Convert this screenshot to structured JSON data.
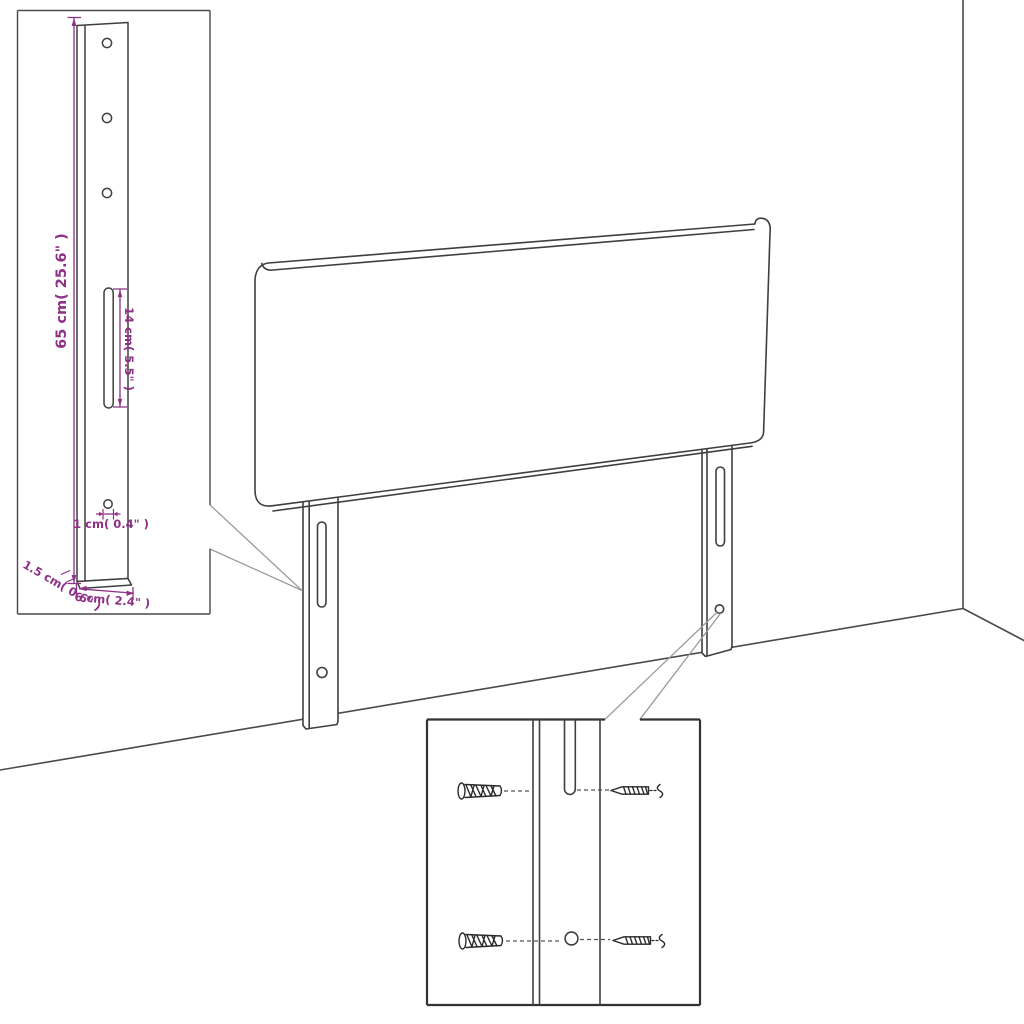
{
  "diagram": {
    "type": "product-assembly-dimension-diagram",
    "subject": "upholstered headboard with two adjustable mounting legs shown in a room corner",
    "colors": {
      "outline": "#3f3f3f",
      "callout": "#9b9b9b",
      "dimension": "#8e3087",
      "inset_border": "#333333",
      "background": "#ffffff"
    },
    "dimensions": {
      "leg_height": "65 cm( 25.6\" )",
      "slot_length": "14 cm( 5.5\" )",
      "hole_diameter": "1 cm( 0.4\" )",
      "leg_width": "6 cm( 2.4\" )",
      "leg_thickness": "1.5 cm( 0.6\" )"
    },
    "insets": {
      "top_left": "mounting leg detail with drilled holes, slot and dimensions",
      "bottom": "wall fixing detail with wall plugs and screws aligned to leg slot and hole"
    }
  }
}
